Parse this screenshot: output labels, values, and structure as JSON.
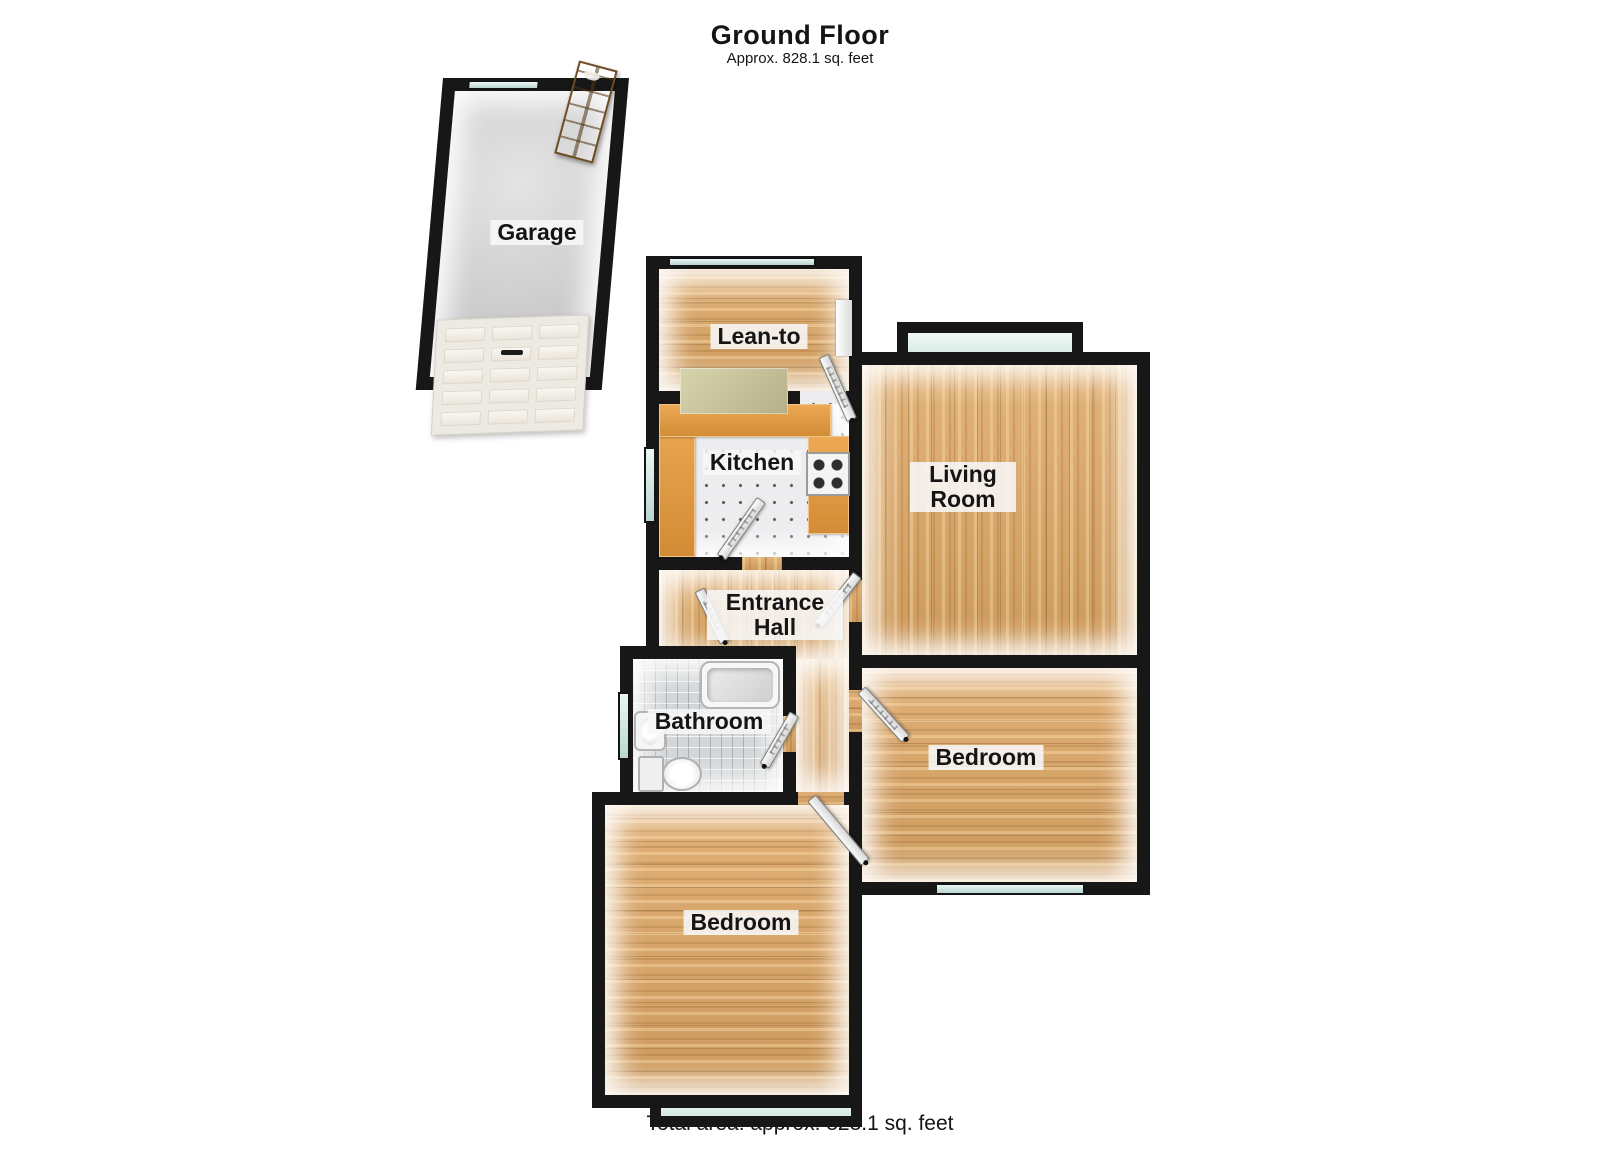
{
  "header": {
    "title": "Ground Floor",
    "subtitle": "Approx. 828.1 sq. feet"
  },
  "rooms": {
    "garage": {
      "label": "Garage"
    },
    "lean_to": {
      "label": "Lean-to"
    },
    "kitchen": {
      "label": "Kitchen"
    },
    "living_room": {
      "label": "Living Room"
    },
    "entrance_hall": {
      "label": "Entrance Hall"
    },
    "bathroom": {
      "label": "Bathroom"
    },
    "bedroom_right": {
      "label": "Bedroom"
    },
    "bedroom_bottom": {
      "label": "Bedroom"
    }
  },
  "footer": {
    "total_area": "Total area: approx. 828.1 sq. feet"
  },
  "colors": {
    "wall": "#171717",
    "wood_floor": "#d6a468",
    "kitchen_tile": "#ededf0",
    "bath_tile": "#d3d6d8",
    "concrete": "#d2d2d2",
    "window_glass": "#dceeeb",
    "counter": "#e09a45",
    "entry_door_wood": "#b5854a",
    "label_background": "#f7f7f7",
    "text": "#151515"
  }
}
